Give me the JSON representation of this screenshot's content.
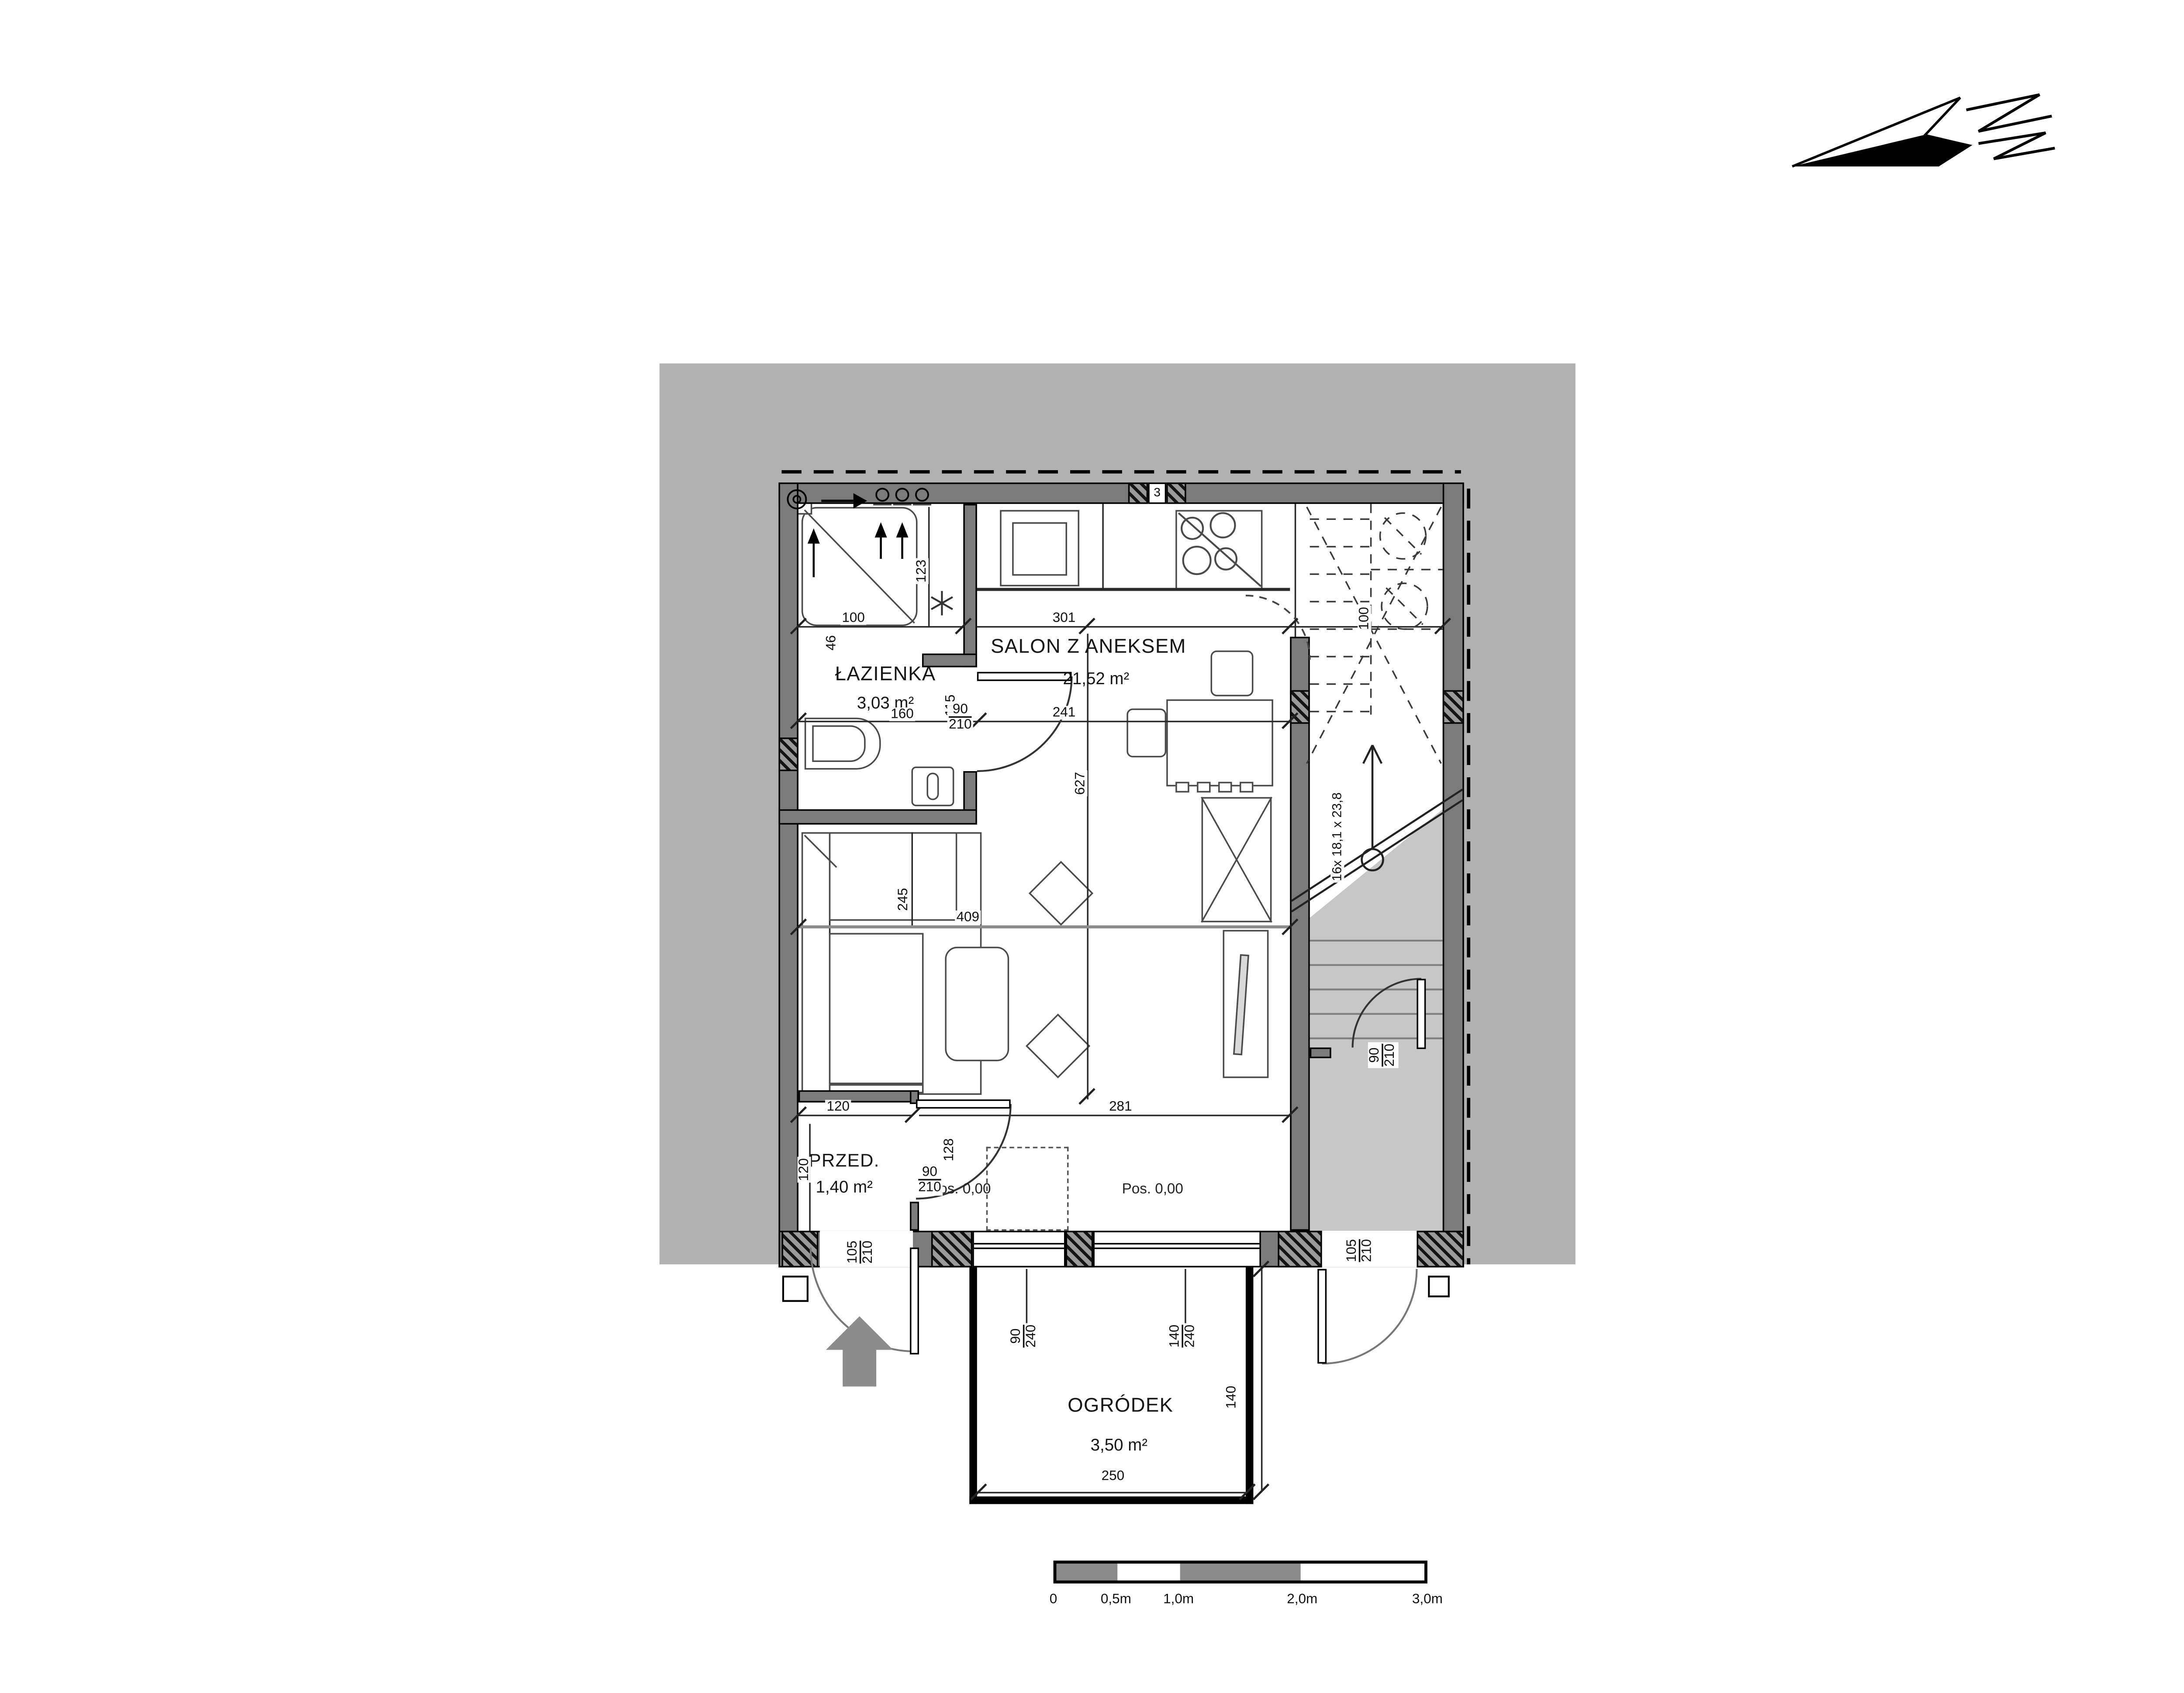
{
  "rooms": {
    "lazienka": {
      "name": "ŁAZIENKA",
      "area": "3,03 m²"
    },
    "salon": {
      "name": "SALON Z ANEKSEM",
      "area": "21,52 m²"
    },
    "przedpokoj": {
      "name": "PRZED.",
      "area": "1,40 m²"
    },
    "ogrodek": {
      "name": "OGRÓDEK",
      "area": "3,50 m²"
    }
  },
  "levels": {
    "salon_left": "Pos. 0,00",
    "salon_right": "Pos. 0,00"
  },
  "stairs": {
    "run_label": "16x 18,1 x 23,8"
  },
  "wall_marker": "3",
  "dims": {
    "shower": "100",
    "bath_side": "46",
    "shaft_height": "123",
    "bath_width": "160",
    "bath_depth": "115",
    "salon_top": "301",
    "salon_mid": "241",
    "salon_length": "627",
    "sofa": "245",
    "living": "409",
    "stair_top": "100",
    "przed_top": "120",
    "przed_side": "120",
    "jamb": "128",
    "salon_bottom": "281",
    "garden_width": "250",
    "garden_depth": "140",
    "bath_door": {
      "w": "90",
      "h": "210"
    },
    "przed_door": {
      "w": "90",
      "h": "210"
    },
    "entry_door": {
      "w": "105",
      "h": "210"
    },
    "landing_door": {
      "w": "90",
      "h": "210"
    },
    "right_exit": {
      "w": "105",
      "h": "210"
    },
    "garden_door": {
      "w": "90",
      "h": "240"
    },
    "garden_window": {
      "w": "140",
      "h": "240"
    }
  },
  "scalebar": {
    "labels": [
      "0",
      "0,5m",
      "1,0m",
      "2,0m",
      "3,0m"
    ]
  },
  "colors": {
    "backdrop": "#b1b1b1",
    "wall": "#7b7b7b",
    "stair_floor": "#c7c7c7",
    "entry_arrow": "#8c8c8c"
  }
}
